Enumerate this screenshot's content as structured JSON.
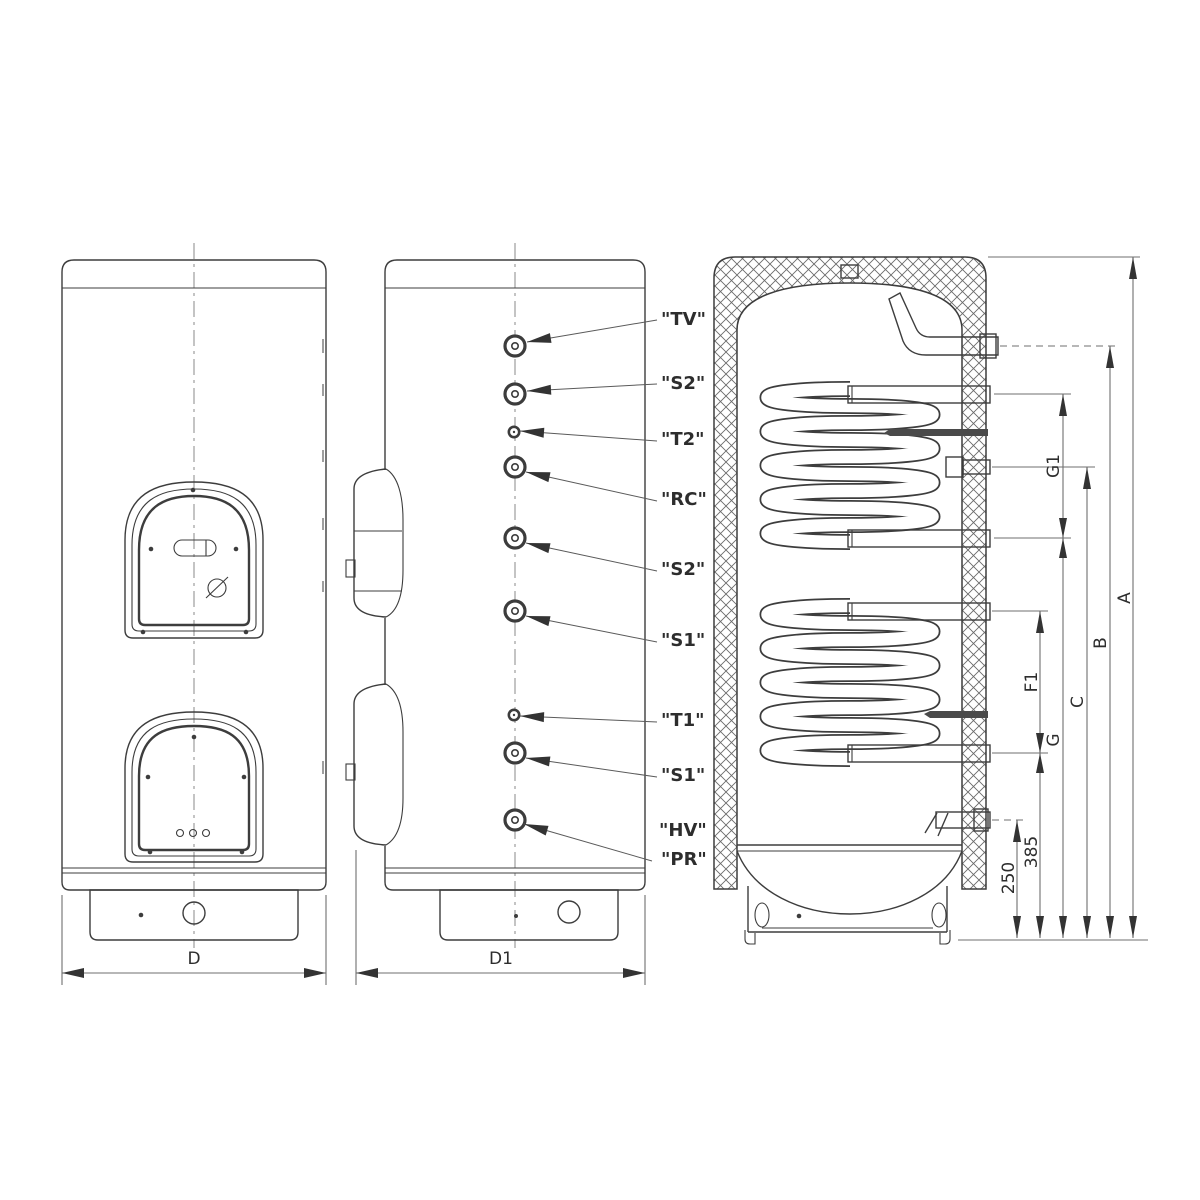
{
  "ports": {
    "tv": "\"TV\"",
    "s2_top": "\"S2\"",
    "t2": "\"T2\"",
    "rc": "\"RC\"",
    "s2_bottom": "\"S2\"",
    "s1_top": "\"S1\"",
    "t1": "\"T1\"",
    "s1_bottom": "\"S1\"",
    "hv": "\"HV\"",
    "pr": "\"PR\""
  },
  "dims": {
    "d": "D",
    "d1": "D1",
    "a": "A",
    "b": "B",
    "c": "C",
    "g": "G",
    "g1": "G1",
    "f1": "F1",
    "n385": "385",
    "n250": "250"
  }
}
